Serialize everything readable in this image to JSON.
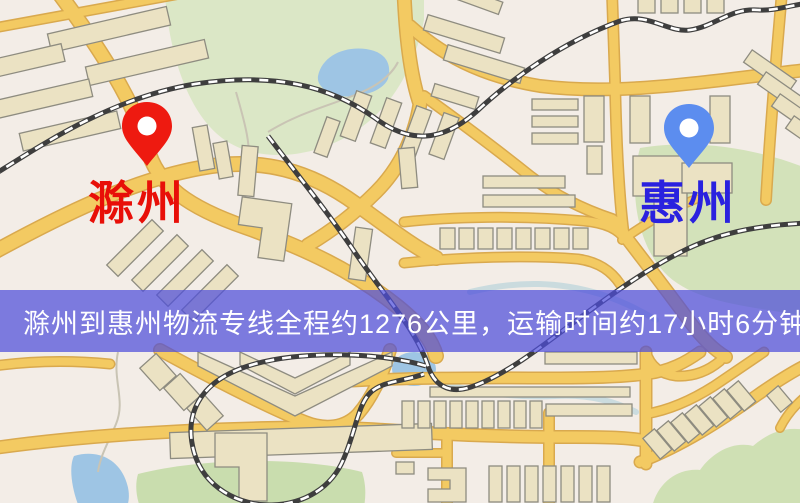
{
  "page": {
    "type": "logistics-route-map-image",
    "width": 800,
    "height": 503
  },
  "markers": {
    "origin": {
      "label": "滁州",
      "icon": "map-pin-icon",
      "pin_color": "#ee1a10",
      "label_color": "#e80f08"
    },
    "destination": {
      "label": "惠州",
      "icon": "map-pin-icon",
      "pin_color": "#5c8def",
      "label_color": "#2a21df"
    }
  },
  "banner": {
    "text": "滁州到惠州物流专线全程约1276公里，运输时间约17小时6分钟.",
    "background": "rgba(77,78,219,0.72)",
    "text_color": "#ffffff"
  },
  "route": {
    "origin": "滁州",
    "destination": "惠州",
    "distance_text": "约1276公里",
    "duration_text": "约17小时6分钟"
  },
  "map_colors": {
    "background": "#f3ede7",
    "road": "#f3ca62",
    "road_casing": "#d9a94e",
    "railway": "#3e3e3e",
    "park": "#d8e5c0",
    "water": "#9ec5e4",
    "building": "#ebe2c3",
    "building_outline": "#8e8c80"
  }
}
